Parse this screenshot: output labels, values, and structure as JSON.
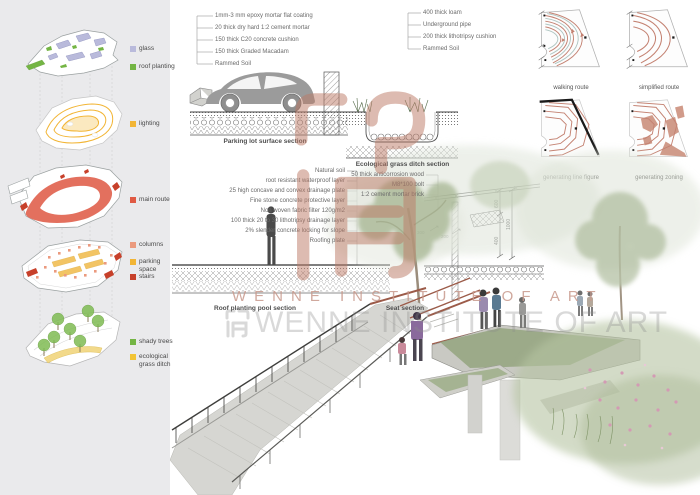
{
  "axon_legend": {
    "items": [
      {
        "label": "glass",
        "color": "#b9badb"
      },
      {
        "label": "roof planting",
        "color": "#74b544"
      },
      {
        "label": "lighting",
        "color": "#f2b535"
      },
      {
        "label": "main route",
        "color": "#e05a44"
      },
      {
        "label": "columns",
        "color": "#eb9a7e"
      },
      {
        "label": "parking space",
        "color": "#f2b535"
      },
      {
        "label": "stairs",
        "color": "#c7402a"
      },
      {
        "label": "shady trees",
        "color": "#74b544"
      },
      {
        "label": "ecological grass ditch",
        "color": "#f2c435"
      }
    ]
  },
  "sections": {
    "parking_lot": {
      "label": "Parking lot surface section",
      "callouts": [
        "1mm-3 mm epoxy mortar flat coating",
        "20 thick dry hard 1:2 cement mortar",
        "150 thick C20 concrete cushion",
        "150 thick Graded Macadam",
        "Rammed Soil"
      ]
    },
    "grass_ditch": {
      "label": "Ecological grass ditch section",
      "callouts": [
        "400 thick loam",
        "Underground pipe",
        "200 thick lithotripsy cushion",
        "Rammed Soil"
      ]
    },
    "roof_pool": {
      "label": "Roof planting pool section",
      "callouts": [
        "Natural soil",
        "root resistant waterproof layer",
        "25 high concave and convex drainage plate",
        "Fine stone concrete protective layer",
        "Non woven fabric filter 120g/m2",
        "100 thick 20 to 30 lithotripsy drainage layer",
        "2% slender concrete locking for slope",
        "Roofing plate"
      ]
    },
    "seat": {
      "label": "Seat section",
      "callouts": [
        "50 thick anticorrosion wood",
        "M8*100 bolt",
        "1:2 cement mortar brick"
      ],
      "dims": [
        "600",
        "1000",
        "400"
      ],
      "small_dims": [
        "300",
        "200"
      ]
    }
  },
  "route_diagrams": {
    "labels": [
      "walking route",
      "simplified route",
      "generating line figure",
      "generating zoning"
    ]
  },
  "watermark": {
    "line1": "WENNE INSTITUTE OF ART",
    "line2": "WENNE INSTITUTE OF ART"
  }
}
